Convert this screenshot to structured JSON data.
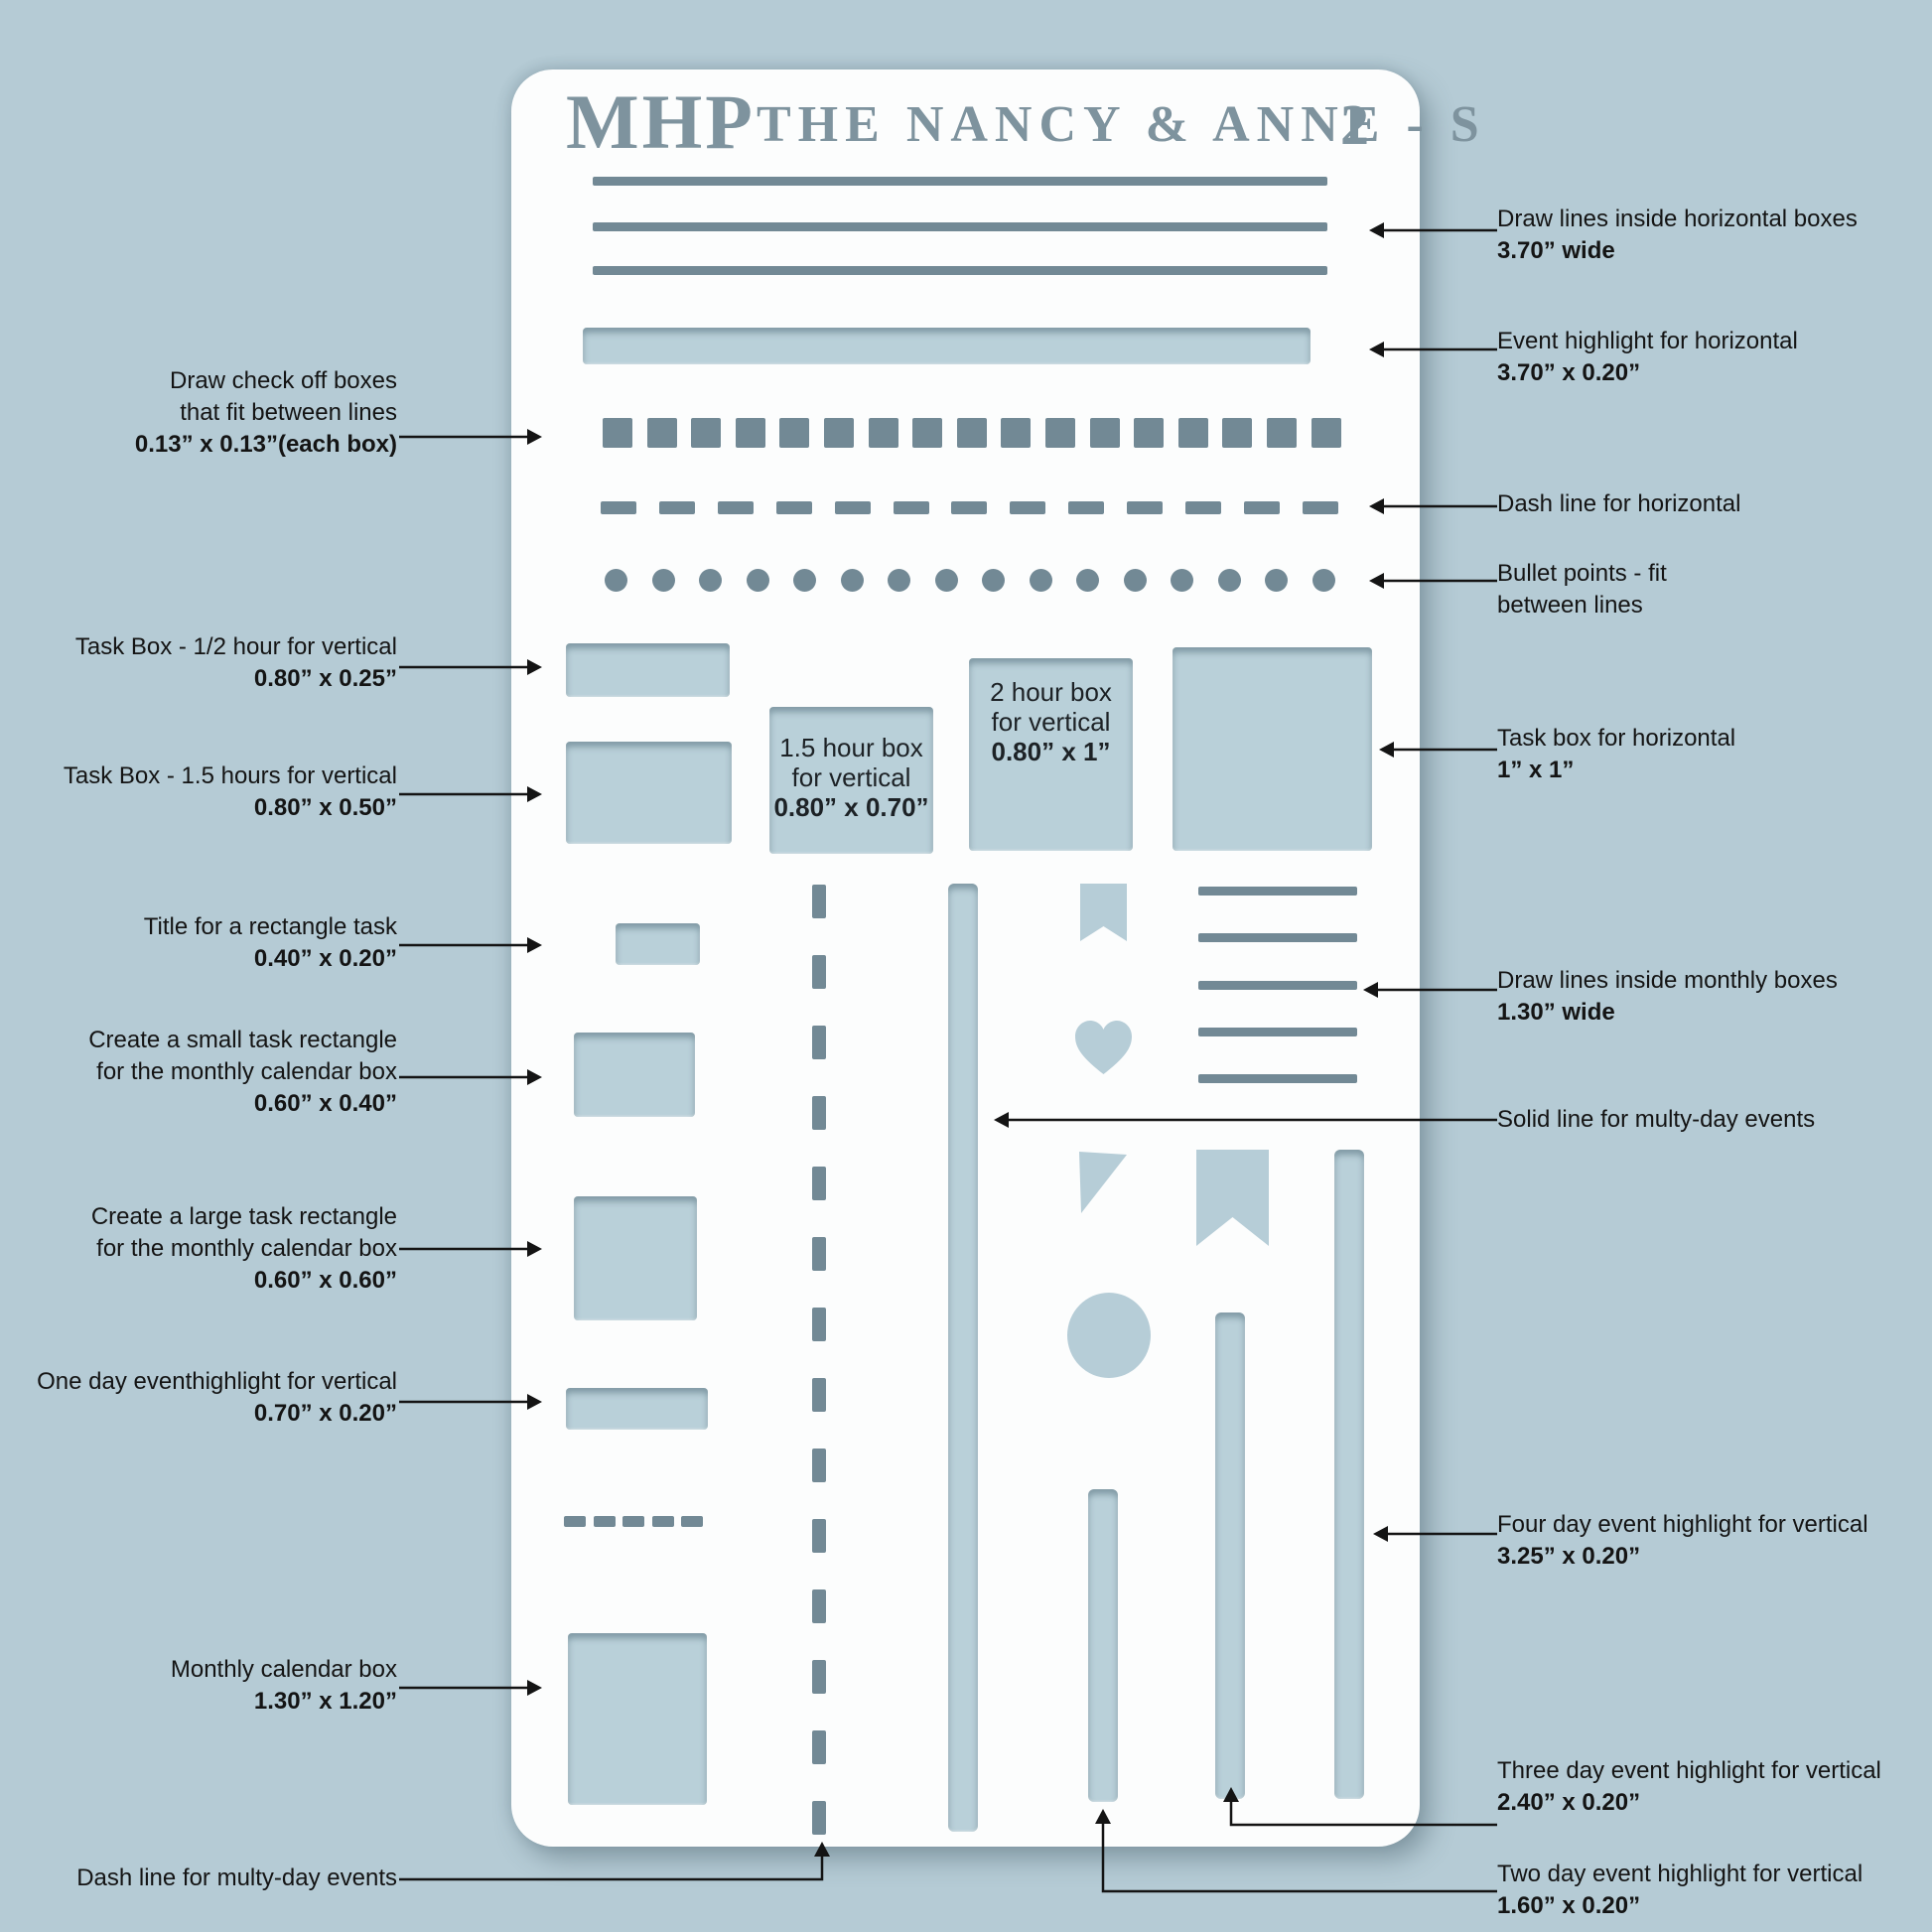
{
  "colors": {
    "background": "#b5cbd5",
    "panel": "#fcfdfd",
    "cutout": "#b9d0d9",
    "slot": "#728995",
    "title": "#7e939e",
    "text": "#141414"
  },
  "stencil": {
    "brand": "MHP",
    "series_title": "THE NANCY & ANNE - S",
    "number": "2",
    "counts": {
      "horizontal_lines": 3,
      "check_boxes": 17,
      "dashes": 13,
      "bullets": 16,
      "monthly_lines": 5,
      "vertical_dashes": 14,
      "small_dashes": 5
    },
    "inner_labels": {
      "box_15": {
        "l1": "1.5 hour box",
        "l2": "for vertical",
        "dims": "0.80” x 0.70”"
      },
      "box_2": {
        "l1": "2 hour box",
        "l2": "for vertical",
        "dims": "0.80” x 1”"
      }
    }
  },
  "annotations": {
    "left": [
      {
        "l1": "Draw check off boxes",
        "l2": "that fit between lines",
        "dims": "0.13” x 0.13”(each box)"
      },
      {
        "l1": "Task Box - 1/2 hour for vertical",
        "dims": "0.80” x 0.25”"
      },
      {
        "l1": "Task Box - 1.5 hours for vertical",
        "dims": "0.80” x 0.50”"
      },
      {
        "l1": "Title for  a rectangle task",
        "dims": "0.40” x 0.20”"
      },
      {
        "l1": "Create a small task rectangle",
        "l2": "for the monthly calendar box",
        "dims": "0.60” x 0.40”"
      },
      {
        "l1": "Create a large task rectangle",
        "l2": "for the monthly calendar box",
        "dims": "0.60” x 0.60”"
      },
      {
        "l1": "One day eventhighlight for vertical",
        "dims": "0.70” x 0.20”"
      },
      {
        "l1": "Monthly calendar box",
        "dims": "1.30” x 1.20”"
      },
      {
        "l1": "Dash line for multy-day events"
      }
    ],
    "right": [
      {
        "l1": "Draw lines inside horizontal boxes",
        "dims": "3.70” wide"
      },
      {
        "l1": "Event highlight for horizontal",
        "dims": "3.70” x 0.20”"
      },
      {
        "l1": "Dash line for horizontal"
      },
      {
        "l1": "Bullet points - fit",
        "l2": "between lines"
      },
      {
        "l1": "Task box for horizontal",
        "dims": "1” x 1”"
      },
      {
        "l1": "Draw lines inside monthly boxes",
        "dims": "1.30” wide"
      },
      {
        "l1": "Solid line for multy-day events"
      },
      {
        "l1": "Four day event highlight for vertical",
        "dims": "3.25” x 0.20”"
      },
      {
        "l1": "Three day event highlight for vertical",
        "dims": "2.40” x 0.20”"
      },
      {
        "l1": "Two day event highlight for vertical",
        "dims": "1.60” x 0.20”"
      }
    ]
  }
}
